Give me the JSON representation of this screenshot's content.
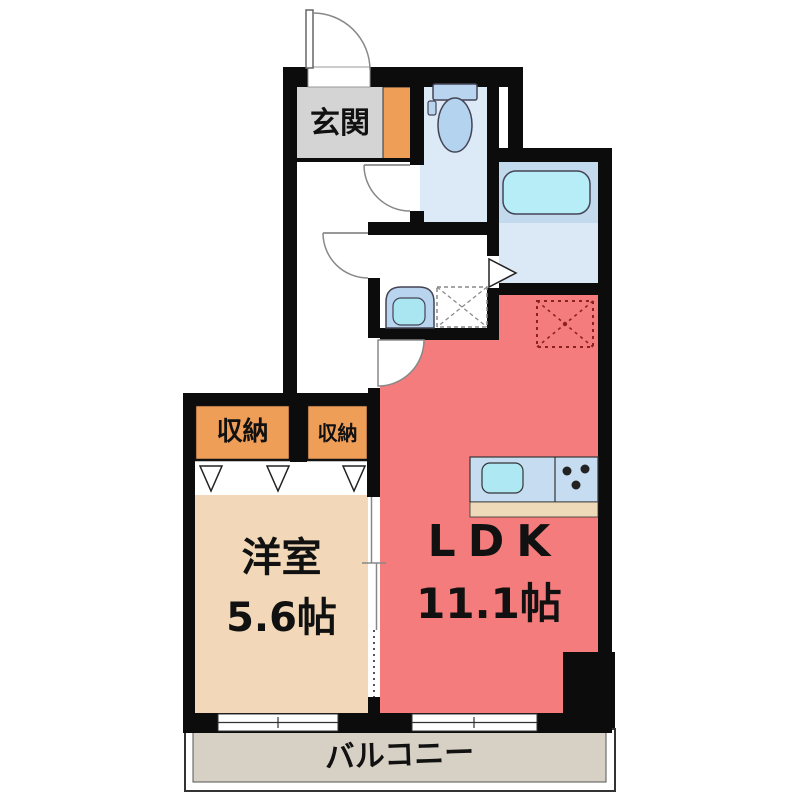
{
  "floorplan": {
    "rooms": {
      "genkan": {
        "label": "玄関"
      },
      "closet_left": {
        "label": "収納"
      },
      "closet_right": {
        "label": "収納"
      },
      "western_room": {
        "label": "洋室",
        "area": "5.6帖"
      },
      "ldk": {
        "label": "LDK",
        "area": "11.1帖"
      },
      "balcony": {
        "label": "バルコニー"
      }
    },
    "fixtures": [
      "toilet-icon",
      "bathtub-icon",
      "washbasin-icon",
      "washing-machine-space-icon",
      "refrigerator-space-icon",
      "kitchen-sink-icon",
      "stove-burners-icon",
      "entrance-door-icon",
      "hinged-door-icon",
      "sliding-door-icon",
      "folding-door-icon",
      "window-icon"
    ],
    "colors": {
      "wall": "#0c0c0c",
      "ldk": "#f57c7c",
      "western_room": "#f2d8b8",
      "closet": "#ef9e58",
      "genkan": "#d4d4d4",
      "toilet_floor": "#dce9f7",
      "bath_upper": "#c3d9ee",
      "bath_floor": "#dbe8f5",
      "bathtub": "#b6edf6",
      "fixture_blue": "#b9d4ef",
      "basin_inner": "#a9e6f2",
      "kitchen_counter": "#c6ddf1",
      "kitchen_strip": "#eed9b8",
      "balcony": "#d7d1c5",
      "refrigerator_dash": "#8b2222"
    }
  }
}
